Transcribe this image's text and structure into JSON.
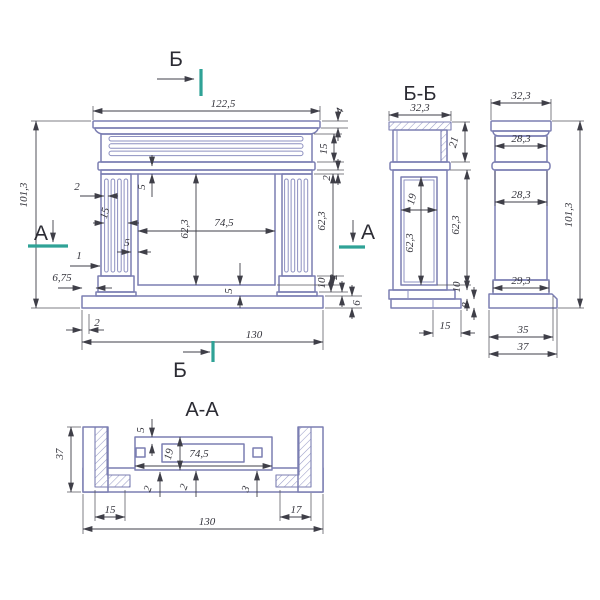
{
  "colors": {
    "line": "#7b7eb2",
    "dim": "#3f3f48",
    "section_mark": "#2fa296",
    "background": "#ffffff"
  },
  "markers": {
    "a_left": "А",
    "a_right": "А",
    "b_top": "Б",
    "b_bottom": "Б"
  },
  "front": {
    "w_top": "122,5",
    "h_left": "101,3",
    "crown4": "4",
    "frieze15": "15",
    "band2": "2",
    "lintel5": "5",
    "flute2": "2",
    "flutes15": "15",
    "jamb5": "5",
    "reveal1": "1",
    "off675": "6,75",
    "open_h": "62,3",
    "open_w": "74,5",
    "sill5": "5",
    "right_h": "62,3",
    "plinth10": "10",
    "foot2": "2",
    "base6": "6",
    "edge2": "2",
    "w_base": "130"
  },
  "bb": {
    "title": "Б-Б",
    "w_top": "32,3",
    "top21": "21",
    "cav19": "19",
    "cav_h": "62,3",
    "side_h": "62,3",
    "p10": "10",
    "p8": "8",
    "foot15": "15"
  },
  "side": {
    "w_top": "32,3",
    "neck283": "28,3",
    "pillar283": "28,3",
    "h": "101,3",
    "basetop293": "29,3",
    "base35": "35",
    "base37": "37"
  },
  "aa": {
    "title": "А-А",
    "t5": "5",
    "d19": "19",
    "open745": "74,5",
    "wall2a": "2",
    "wall2b": "2",
    "wall3": "3",
    "leg15": "15",
    "leg17": "17",
    "w130": "130",
    "d37": "37"
  }
}
